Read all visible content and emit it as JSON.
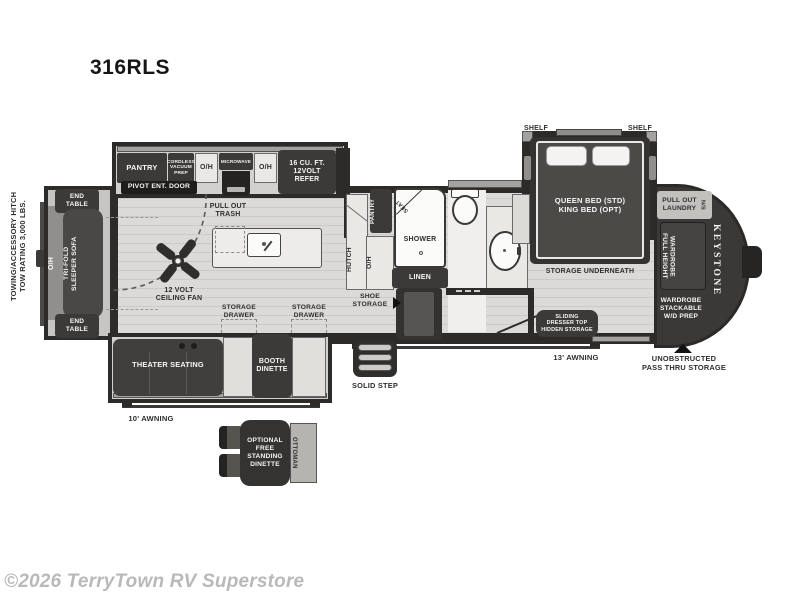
{
  "page": {
    "title": "316RLS",
    "copyright": "©2026 TerryTown RV Superstore"
  },
  "exterior": {
    "hitch_note": "TOWING/ACCESSORY HITCH\nTOW RATING 3,000 LBS.",
    "brand": "KEYSTONE",
    "ns_label": "N/S",
    "awning_rear": "10' AWNING",
    "awning_front": "13' AWNING",
    "pass_thru": "UNOBSTRUCTED\nPASS THRU STORAGE",
    "solid_step": "SOLID STEP"
  },
  "living": {
    "end_table_top": "END\nTABLE",
    "end_table_bottom": "END\nTABLE",
    "oh_rear": "O/H",
    "sofa": "TRI-FOLD\nSLEEPER SOFA",
    "fan": "12 VOLT\nCEILING FAN",
    "theater": "THEATER SEATING",
    "booth": "BOOTH\nDINETTE"
  },
  "kitchen": {
    "pantry": "PANTRY",
    "cordless": "CORDLESS\nVACUUM\nPREP",
    "oh_left": "O/H",
    "microwave": "MICROWAVE",
    "oh_right": "O/H",
    "refer": "16 CU. FT.\n12VOLT\nREFER",
    "pivot_door": "PIVOT ENT. DOOR",
    "trash": "PULL OUT\nTRASH",
    "drawer1": "STORAGE\nDRAWER",
    "drawer2": "STORAGE\nDRAWER",
    "hutch": "HUTCH",
    "hutch_oh": "O/H",
    "pantry2": "PANTRY"
  },
  "bath": {
    "seat": "SEAT",
    "shower": "SHOWER",
    "linen": "LINEN",
    "shoe": "SHOE\nSTORAGE"
  },
  "bedroom": {
    "shelf_left": "SHELF",
    "shelf_right": "SHELF",
    "bed": "QUEEN BED (STD)\nKING BED (OPT)",
    "under": "STORAGE UNDERNEATH",
    "dresser": "SLIDING\nDRESSER TOP\nHIDDEN STORAGE",
    "laundry": "PULL OUT\nLAUNDRY",
    "wardrobe": "FULL HEIGHT\nWARDROBE",
    "wd_prep": "WARDROBE\nSTACKABLE\nW/D PREP"
  },
  "optional": {
    "dinette": "OPTIONAL\nFREE\nSTANDING\nDINETTE",
    "ottoman": "OTTOMAN"
  },
  "colors": {
    "wall": "#2c2b29",
    "furniture_dark": "#3b3a38",
    "furniture_light": "#e9e8e5",
    "floor": "#dbdad8",
    "slide_trim": "#a3a2a0",
    "copyright_gray": "#b9b9b9"
  }
}
